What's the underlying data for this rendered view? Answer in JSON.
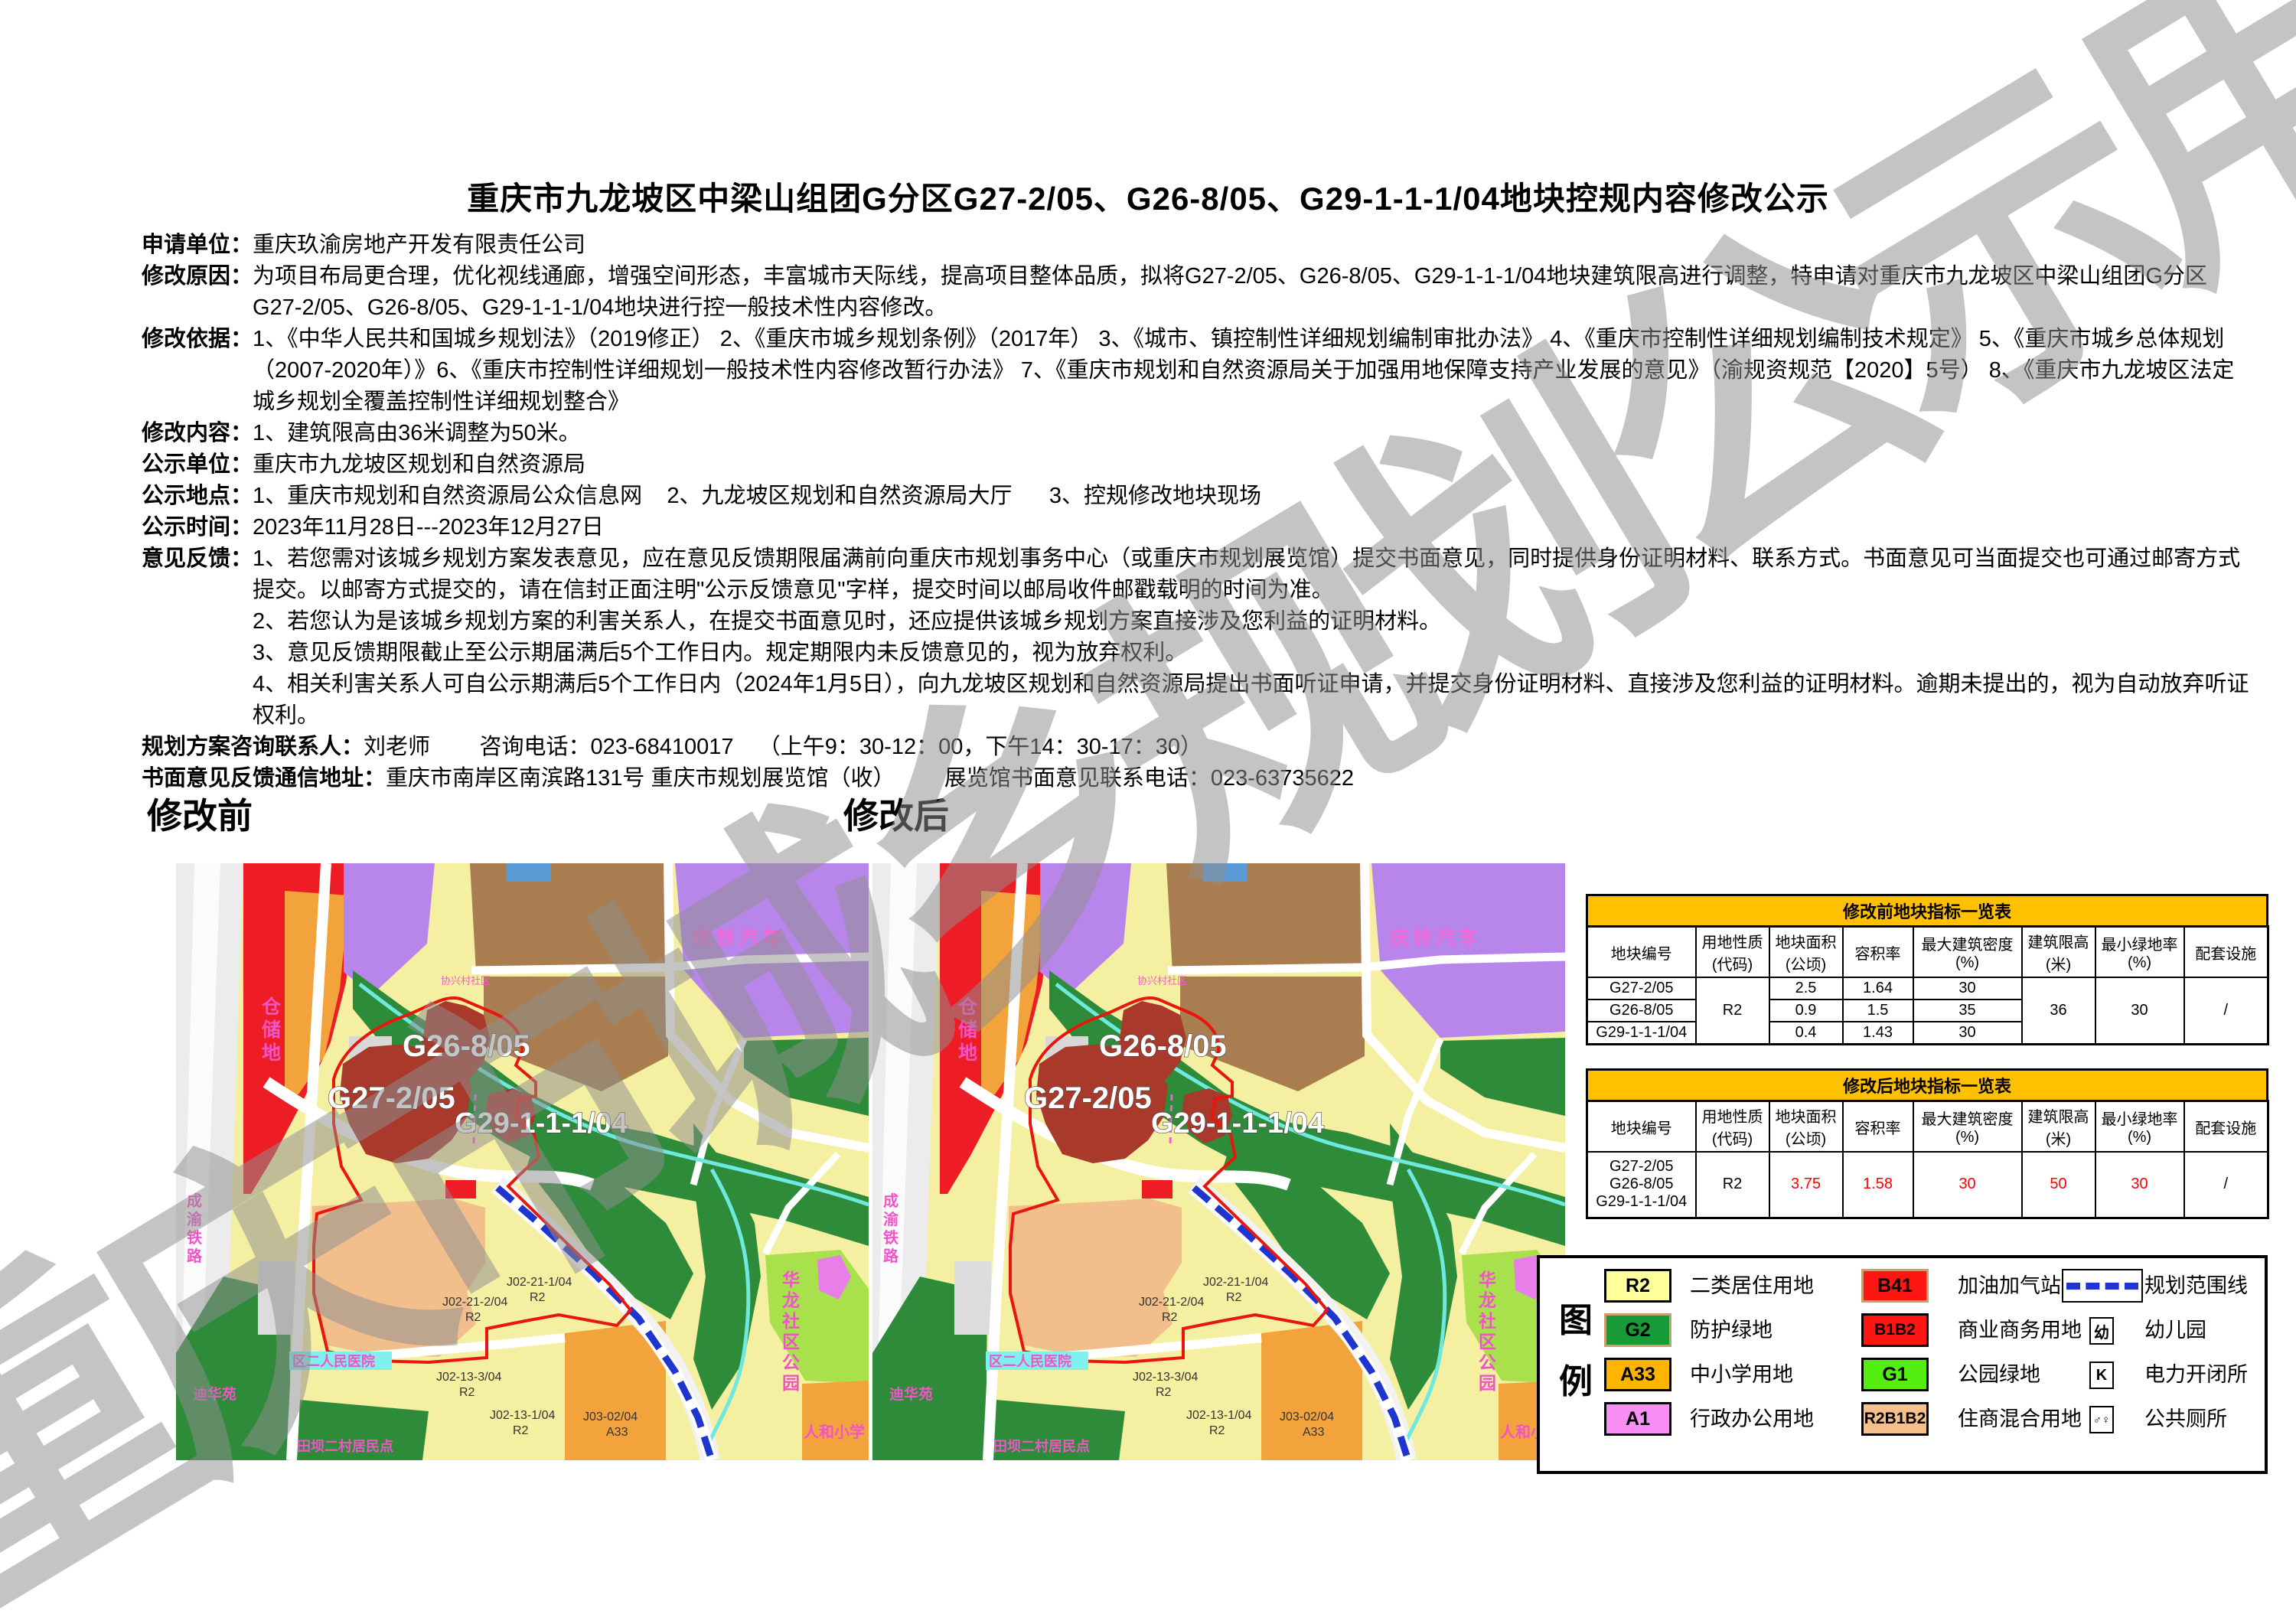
{
  "watermark": {
    "text": "重庆市城乡规划公示用图"
  },
  "title": "重庆市九龙坡区中梁山组团G分区G27-2/05、G26-8/05、G29-1-1-1/04地块控规内容修改公示",
  "info": {
    "rows": [
      {
        "label": "申请单位：",
        "text": "重庆玖渝房地产开发有限责任公司"
      },
      {
        "label": "修改原因：",
        "text": "为项目布局更合理，优化视线通廊，增强空间形态，丰富城市天际线，提高项目整体品质，拟将G27-2/05、G26-8/05、G29-1-1-1/04地块建筑限高进行调整，特申请对重庆市九龙坡区中梁山组团G分区G27-2/05、G26-8/05、G29-1-1-1/04地块进行控一般技术性内容修改。"
      },
      {
        "label": "修改依据：",
        "text": "1、《中华人民共和国城乡规划法》（2019修正） 2、《重庆市城乡规划条例》（2017年） 3、《城市、镇控制性详细规划编制审批办法》 4、《重庆市控制性详细规划编制技术规定》 5、《重庆市城乡总体规划（2007-2020年）》6、《重庆市控制性详细规划一般技术性内容修改暂行办法》 7、《重庆市规划和自然资源局关于加强用地保障支持产业发展的意见》（渝规资规范【2020】5号） 8、《重庆市九龙坡区法定城乡规划全覆盖控制性详细规划整合》"
      },
      {
        "label": "修改内容：",
        "text": "1、建筑限高由36米调整为50米。"
      },
      {
        "label": "公示单位：",
        "text": "重庆市九龙坡区规划和自然资源局"
      },
      {
        "label": "公示地点：",
        "text": "1、重庆市规划和自然资源局公众信息网    2、九龙坡区规划和自然资源局大厅      3、控规修改地块现场"
      },
      {
        "label": "公示时间：",
        "text": "2023年11月28日---2023年12月27日"
      }
    ],
    "feedback": {
      "label": "意见反馈：",
      "items": [
        "1、若您需对该城乡规划方案发表意见，应在意见反馈期限届满前向重庆市规划事务中心（或重庆市规划展览馆）提交书面意见，同时提供身份证明材料、联系方式。书面意见可当面提交也可通过邮寄方式提交。以邮寄方式提交的，请在信封正面注明\"公示反馈意见\"字样，提交时间以邮局收件邮戳载明的时间为准。",
        "2、若您认为是该城乡规划方案的利害关系人，在提交书面意见时，还应提供该城乡规划方案直接涉及您利益的证明材料。",
        "3、意见反馈期限截止至公示期届满后5个工作日内。规定期限内未反馈意见的，视为放弃权利。",
        "4、相关利害关系人可自公示期满后5个工作日内（2024年1月5日），向九龙坡区规划和自然资源局提出书面听证申请，并提交身份证明材料、直接涉及您利益的证明材料。逾期未提出的，视为自动放弃听证权利。"
      ]
    },
    "contacts": [
      {
        "label": "规划方案咨询联系人：",
        "text": "刘老师        咨询电话：023-68410017    （上午9：30-12：00，下午14：30-17：30）"
      },
      {
        "label": "书面意见反馈通信地址：",
        "text": "重庆市南岸区南滨路131号 重庆市规划展览馆（收）        展览馆书面意见联系电话：023-63735622"
      }
    ]
  },
  "maps": {
    "before_title": "修改前",
    "after_title": "修改后",
    "labels": {
      "g26": "G26-8/05",
      "g27": "G27-2/05",
      "g29": "G29-1-1-1/04",
      "qingling": "庆铃汽车",
      "cangchudi": "仓储地",
      "chengyu_railway": "成渝铁路",
      "xiexing": "协兴村社区",
      "hospital": "区二人民医院",
      "dihuayuan": "迪华苑",
      "tianba": "田坝二村居民点",
      "hualong_park": "华龙社区公园",
      "renhe_school": "人和小学"
    },
    "parcel_codes": [
      {
        "code": "J02-21-1/04",
        "zone": "R2"
      },
      {
        "code": "J02-21-2/04",
        "zone": "R2"
      },
      {
        "code": "J02-13-3/04",
        "zone": "R2"
      },
      {
        "code": "J02-13-1/04",
        "zone": "R2"
      },
      {
        "code": "J03-02/04",
        "zone": "A33"
      }
    ]
  },
  "tables": {
    "headers": [
      "地块编号",
      "用地性质\n(代码)",
      "地块面积\n(公顷)",
      "容积率",
      "最大建筑密度\n(%)",
      "建筑限高\n(米)",
      "最小绿地率\n(%)",
      "配套设施"
    ],
    "before": {
      "title": "修改前地块指标一览表",
      "rows": [
        {
          "code": "G27-2/05",
          "area": "2.5",
          "far": "1.64",
          "density": "30"
        },
        {
          "code": "G26-8/05",
          "area": "0.9",
          "far": "1.5",
          "density": "35"
        },
        {
          "code": "G29-1-1-1/04",
          "area": "0.4",
          "far": "1.43",
          "density": "30"
        }
      ],
      "merged": {
        "usage": "R2",
        "height": "36",
        "green": "30",
        "facility": "/"
      }
    },
    "after": {
      "title": "修改后地块指标一览表",
      "codes": [
        "G27-2/05",
        "G26-8/05",
        "G29-1-1-1/04"
      ],
      "values": {
        "usage": "R2",
        "area": "3.75",
        "far": "1.58",
        "density": "30",
        "height": "50",
        "green": "30",
        "facility": "/"
      }
    }
  },
  "legend": {
    "title": "图例",
    "columns": [
      [
        {
          "code": "R2",
          "label": "二类居住用地",
          "color": "#FFFF9C",
          "border": "#000000"
        },
        {
          "code": "G2",
          "label": "防护绿地",
          "color": "#189A38",
          "border": "#C8A06E"
        },
        {
          "code": "A33",
          "label": "中小学用地",
          "color": "#FFB400",
          "border": "#000000"
        },
        {
          "code": "A1",
          "label": "行政办公用地",
          "color": "#F98EF5",
          "border": "#000000"
        }
      ],
      [
        {
          "code": "B41",
          "label": "加油加气站用地",
          "color": "#FF1612",
          "border": "#C8A06E"
        },
        {
          "code": "B1B2",
          "label": "商业商务用地",
          "color": "#FF1612",
          "border": "#000000"
        },
        {
          "code": "G1",
          "label": "公园绿地",
          "color": "#55EE11",
          "border": "#000000"
        },
        {
          "code": "R2B1B2",
          "label": "住商混合用地",
          "color": "#F6C08C",
          "border": "#000000"
        }
      ],
      [
        {
          "type": "dash",
          "label": "规划范围线"
        },
        {
          "type": "box",
          "glyph": "幼",
          "label": "幼儿园"
        },
        {
          "type": "box",
          "glyph": "K",
          "label": "电力开闭所"
        },
        {
          "type": "box",
          "glyph": "♂♀",
          "label": "公共厕所"
        }
      ]
    ]
  }
}
